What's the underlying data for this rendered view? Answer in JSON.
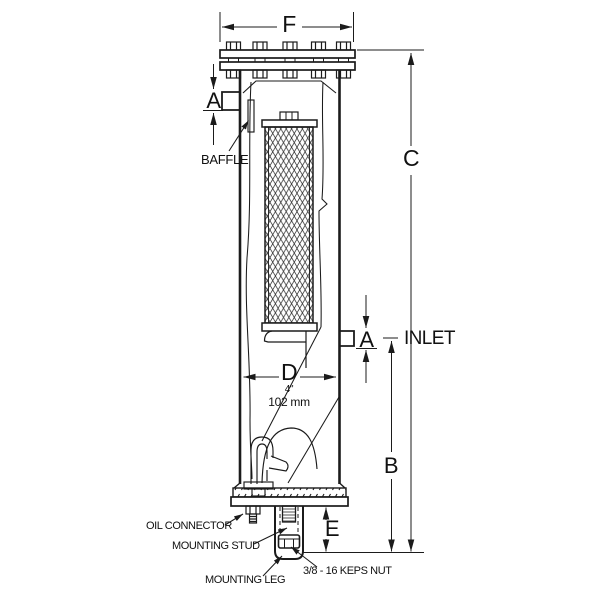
{
  "page": {
    "background": "#ffffff",
    "line_color": "#1b1b1b"
  },
  "dimension_labels": {
    "f": "F",
    "a_outlet": "A",
    "a_inlet": "A",
    "b": "B",
    "c": "C",
    "d": "D",
    "e": "E",
    "d_inches": "4\"",
    "d_mm": "102 mm"
  },
  "part_labels": {
    "baffle": "BAFFLE",
    "inlet": "INLET",
    "oil_connector": "OIL CONNECTOR",
    "mounting_stud": "MOUNTING STUD",
    "mounting_leg": "MOUNTING LEG",
    "keps_nut": "3/8 - 16 KEPS NUT"
  }
}
